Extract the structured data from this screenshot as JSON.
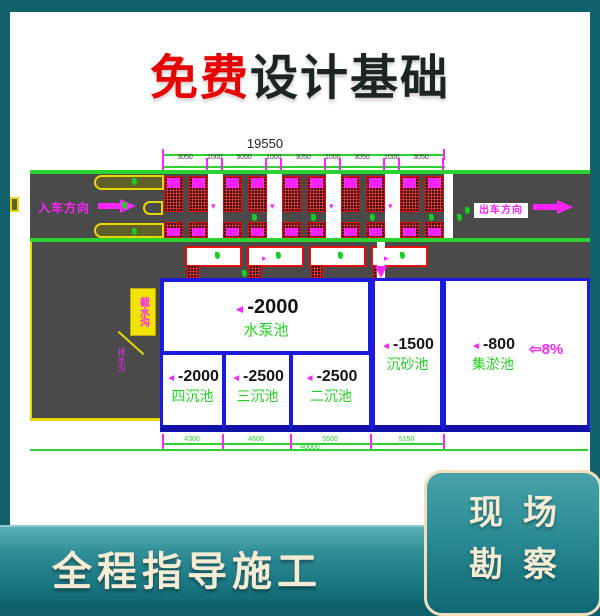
{
  "title": {
    "highlight": "免费",
    "rest": "设计基础"
  },
  "colors": {
    "accent_red": "#e90000",
    "frame_teal": "#11616c",
    "cad_green": "#2bd331",
    "cad_magenta": "#ff24ff",
    "pool_blue": "#1a1ae0",
    "cream": "#f6ecd4"
  },
  "diagram": {
    "total_dim": "19550",
    "dim_segments": [
      "3050",
      "1000",
      "3050",
      "1000",
      "3050",
      "1000",
      "3050",
      "1000",
      "3050"
    ],
    "entry_label": "入车方向",
    "exit_label": "出车方向",
    "marker": "◄",
    "slope_label": "⇦8%",
    "callout_label": "截水沟",
    "callout_small_label": "排水沟",
    "pools": {
      "pump": {
        "depth": "-2000",
        "name": "水泵池"
      },
      "grit": {
        "depth": "-1500",
        "name": "沉砂池"
      },
      "silt": {
        "depth": "-800",
        "name": "集淤池"
      },
      "sed4": {
        "depth": "-2000",
        "name": "四沉池"
      },
      "sed3": {
        "depth": "-2500",
        "name": "三沉池"
      },
      "sed2": {
        "depth": "-2500",
        "name": "二沉池"
      }
    },
    "bottom_dims": [
      "4300",
      "4600",
      "5500",
      "5150"
    ],
    "overall_dim": "40000"
  },
  "footer": {
    "label": "全程指导施工"
  },
  "corner_card": {
    "line1": "现场",
    "line2": "勘察"
  }
}
